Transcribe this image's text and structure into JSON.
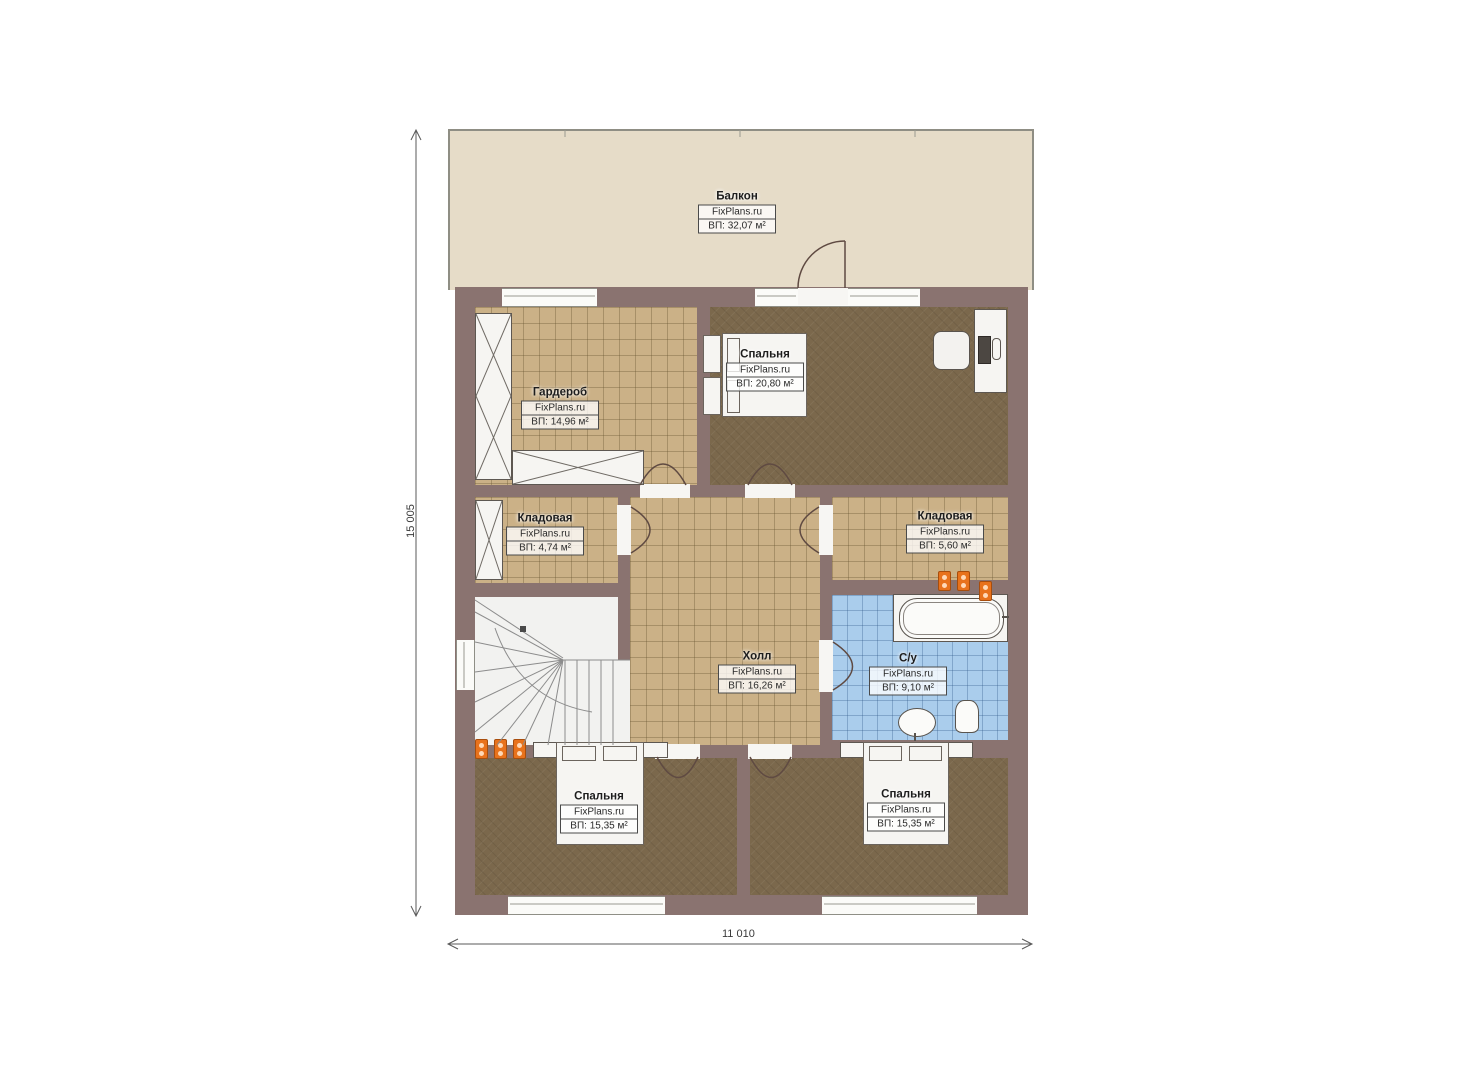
{
  "plan": {
    "brand": "FixPlans.ru",
    "dimensions": {
      "height_label": "15 005",
      "width_label": "11 010"
    },
    "colors": {
      "wall": "#8a7370",
      "balcony_floor": "#e6dcc8",
      "tile_floor": "#cbb187",
      "carpet_floor": "#7b684c",
      "bath_tile": "#aacdec",
      "radiator": "#e8721c"
    },
    "rooms": [
      {
        "id": "balcony",
        "name": "Балкон",
        "brand": "FixPlans.ru",
        "area": "ВП: 32,07 м²"
      },
      {
        "id": "wardrobe",
        "name": "Гардероб",
        "brand": "FixPlans.ru",
        "area": "ВП: 14,96 м²"
      },
      {
        "id": "bedroom-top",
        "name": "Спальня",
        "brand": "FixPlans.ru",
        "area": "ВП: 20,80 м²"
      },
      {
        "id": "storage-left",
        "name": "Кладовая",
        "brand": "FixPlans.ru",
        "area": "ВП: 4,74 м²"
      },
      {
        "id": "storage-right",
        "name": "Кладовая",
        "brand": "FixPlans.ru",
        "area": "ВП: 5,60 м²"
      },
      {
        "id": "hall",
        "name": "Холл",
        "brand": "FixPlans.ru",
        "area": "ВП: 16,26 м²"
      },
      {
        "id": "bathroom",
        "name": "С/у",
        "brand": "FixPlans.ru",
        "area": "ВП: 9,10 м²"
      },
      {
        "id": "bedroom-bottom-left",
        "name": "Спальня",
        "brand": "FixPlans.ru",
        "area": "ВП: 15,35 м²"
      },
      {
        "id": "bedroom-bottom-right",
        "name": "Спальня",
        "brand": "FixPlans.ru",
        "area": "ВП: 15,35 м²"
      }
    ]
  }
}
